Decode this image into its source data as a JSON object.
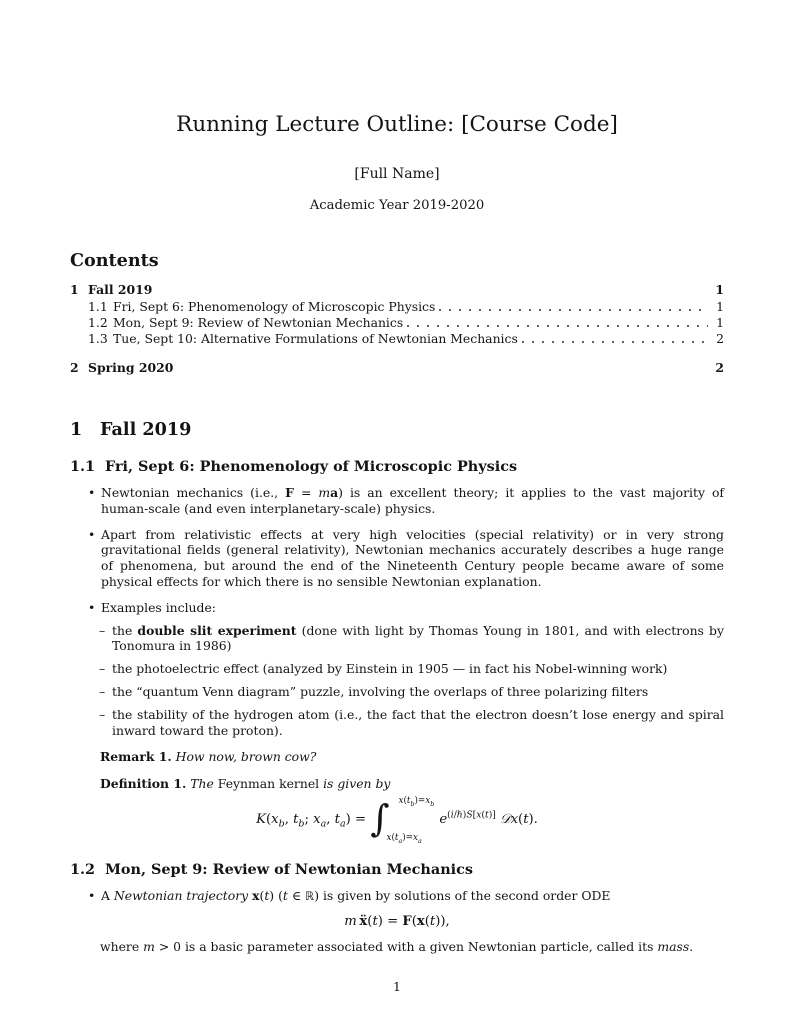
{
  "glyphs": {
    "bullet": "•",
    "dash": "–"
  },
  "document": {
    "title": "Running Lecture Outline: [Course Code]",
    "author": "[Full Name]",
    "date": "Academic Year 2019-2020",
    "footer_page_number": "1"
  },
  "contents": {
    "heading": "Contents",
    "entries": [
      {
        "number": "1",
        "label": "Fall 2019",
        "page": "1"
      },
      {
        "number": "1.1",
        "label": "Fri, Sept 6: Phenomenology of Microscopic Physics",
        "page": "1"
      },
      {
        "number": "1.2",
        "label": "Mon, Sept 9: Review of Newtonian Mechanics",
        "page": "1"
      },
      {
        "number": "1.3",
        "label": "Tue, Sept 10: Alternative Formulations of Newtonian Mechanics",
        "page": "2"
      },
      {
        "number": "2",
        "label": "Spring 2020",
        "page": "2"
      }
    ]
  },
  "body": {
    "section1": {
      "number": "1",
      "title": "Fall 2019"
    },
    "sub11": {
      "number": "1.1",
      "title": "Fri, Sept 6: Phenomenology of Microscopic Physics",
      "bullet1_html": "Newtonian mechanics (i.e., <b>F</b> = <i>m</i><b>a</b>) is an excellent theory; it applies to the vast majority of human-scale (and even interplanetary-scale) physics.",
      "bullet2_html": "Apart from relativistic effects at very high velocities (special relativity) or in very strong gravitational fields (general relativity), Newtonian mechanics accurately describes a huge range of phenomena, but around the end of the Nineteenth Century people became aware of some physical effects for which there is no sensible Newtonian explanation.",
      "bullet3_html": "Examples include:",
      "examples": [
        {
          "html": "the <b>double slit experiment</b> (done with light by Thomas Young in 1801, and with electrons by Tonomura in 1986)"
        },
        {
          "html": "the photoelectric effect (analyzed by Einstein in 1905 — in fact his Nobel-winning work)"
        },
        {
          "html": "the “quantum Venn diagram” puzzle, involving the overlaps of three polarizing filters"
        },
        {
          "html": "the stability of the hydrogen atom (i.e., the fact that the electron doesn’t lose energy and spiral inward toward the proton)."
        }
      ],
      "remark_label": "Remark 1.",
      "remark_html": "<i>How now, brown cow?</i>",
      "definition_label": "Definition 1.",
      "definition_html": "<i>The</i> Feynman kernel <i>is given by</i>",
      "formula_html": "<i>K</i>(<i>x</i><sub><i>b</i></sub>, <i>t</i><sub><i>b</i></sub>; <i>x</i><sub><i>a</i></sub>, <i>t</i><sub><i>a</i></sub>) = <span class='bigint'>∫</span><span class='lims'><span class='lim'><i>x</i>(<i>t</i><sub><i>b</i></sub>)=<i>x</i><sub><i>b</i></sub></span><span class='lim'><i>x</i>(<i>t</i><sub><i>a</i></sub>)=<i>x</i><sub><i>a</i></sub></span></span><i>e</i><sup class='expsup'>(<i>i</i>/ℏ)<i>S</i>[<i>x</i>(<i>t</i>)]</sup> <i>𝒟x</i>(<i>t</i>)."
    },
    "sub12": {
      "number": "1.2",
      "title": "Mon, Sept 9: Review of Newtonian Mechanics",
      "bullet1_html": "A <i>Newtonian trajectory</i> <b>x</b>(<i>t</i>) (<i>t</i> ∈ <span class='dbl'>ℝ</span>) is given by solutions of the second order ODE",
      "formula_html": "<i>m</i>&thinsp;<b>ẍ</b>(<i>t</i>) = <b>F</b>(<b>x</b>(<i>t</i>)),",
      "after_html": "where <i>m</i> &gt; 0 is a basic parameter associated with a given Newtonian particle, called its <i>mass</i>."
    }
  }
}
